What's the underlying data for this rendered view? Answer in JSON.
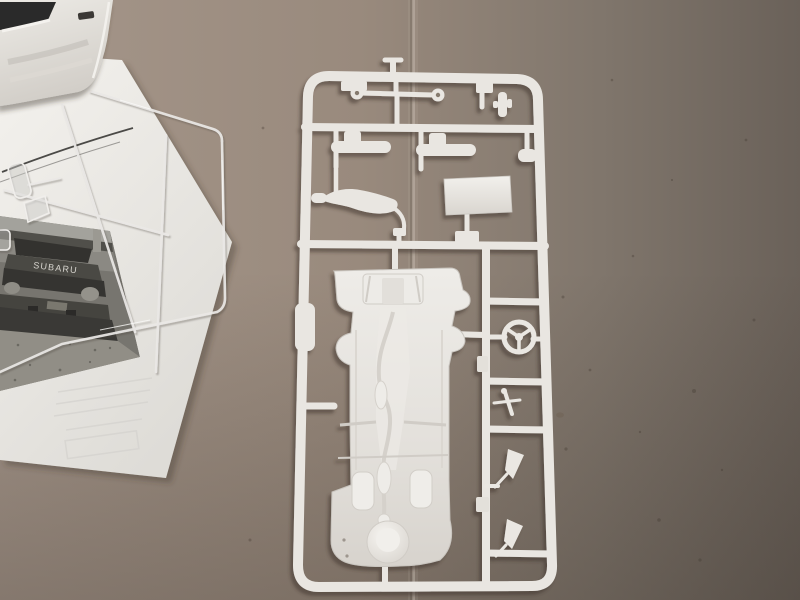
{
  "scene": {
    "type": "photograph",
    "subject": "Plastic scale model car kit parts laid out on a cardboard surface",
    "setting": "tabletop, dim indoor lighting, seam line running vertically through the cardboard",
    "colors": {
      "cardboard_light": "#a3948a",
      "cardboard_dark": "#6b625a",
      "plastic_white": "#e9e6e1",
      "plastic_inner_detail": "#d5d1cb",
      "paper_white": "#edebe7",
      "photo_gray": "#77756f",
      "shadow_brown": "#3a322b",
      "clear_plastic_edge": "#ebe9e6"
    },
    "objects": [
      {
        "label": "white car body shell, partial, top-left corner"
      },
      {
        "label": "folded instruction sheet with black-and-white box-art photo"
      },
      {
        "label": "clear transparent parts sprue lying over the instruction sheet"
      },
      {
        "label": "large white injection-molded sprue with chassis plate and detail parts"
      }
    ],
    "main_sprue": {
      "parts": [
        "chassis floor pan with engine, exhaust and spare-wheel dome detail",
        "front axle rod with eyelet ends",
        "two shock absorber cylinders",
        "curved exhaust muffler",
        "flat rectangular panel",
        "three-spoke steering wheel",
        "gear shift lever assembly",
        "two door mirrors",
        "small brackets and tabs"
      ]
    },
    "instruction_sheet": {
      "photo": {
        "brand_text": "SUBARU",
        "description": "front view of a Subaru rally car standing on gravel, black and white"
      }
    }
  }
}
